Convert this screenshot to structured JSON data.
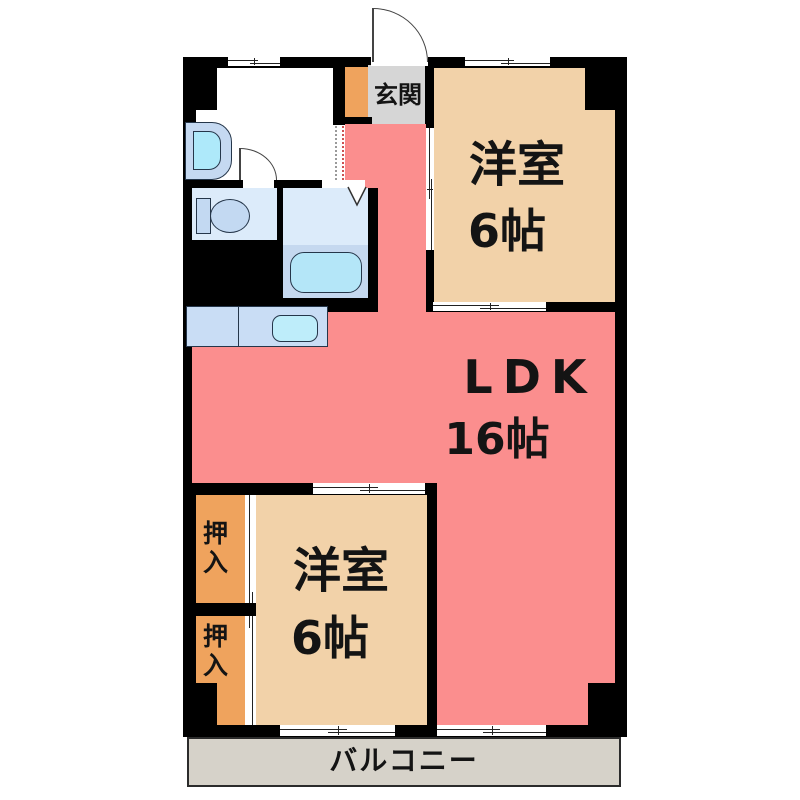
{
  "floor_plan": {
    "type": "apartment-floor-plan",
    "rooms": {
      "genkan": {
        "label": "玄関"
      },
      "western_room_top": {
        "label": "洋室",
        "size": "6帖"
      },
      "ldk": {
        "label": "LDK",
        "size": "16帖"
      },
      "western_room_bottom": {
        "label": "洋室",
        "size": "6帖"
      },
      "closet_upper": {
        "label": "押入"
      },
      "closet_lower": {
        "label": "押入"
      },
      "balcony": {
        "label": "バルコニー"
      }
    },
    "fixtures": [
      "washbasin-icon",
      "toilet-icon",
      "bathtub-icon",
      "bath-folding-door-icon",
      "kitchen-counter",
      "kitchen-sink-icon",
      "entrance-door-arc-icon",
      "interior-door-arc-icon",
      "sliding-window-icon",
      "sliding-door-icon"
    ],
    "colors": {
      "wall": "#000000",
      "ldk_fill": "#FB8E8E",
      "room_fill": "#F2D2A9",
      "closet_fill": "#EFA35D",
      "genkan_fill": "#D6D6D6",
      "balcony_fill": "#D6D2C9",
      "wet_area_fill": "#DCEBFA",
      "bath_floor_fill": "#C5D8EF",
      "fixture_fill": "#C3D9F2",
      "water_fill": "#AEE9FA",
      "text": "#141414"
    }
  }
}
